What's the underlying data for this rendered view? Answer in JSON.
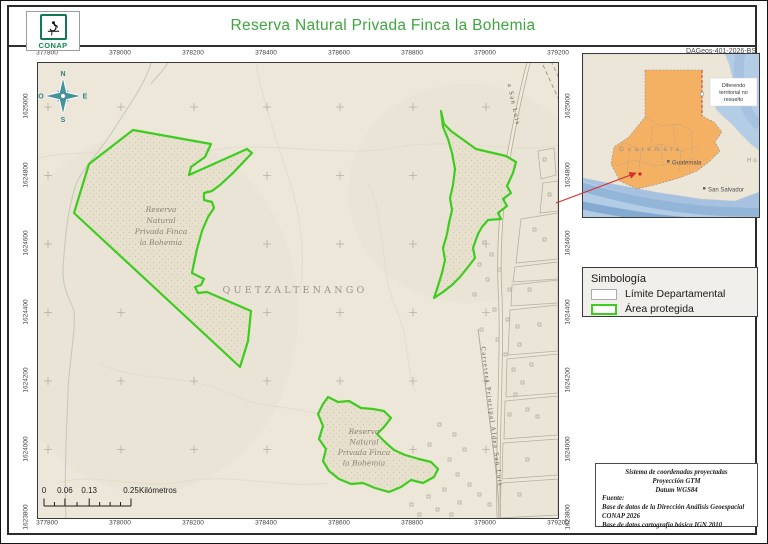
{
  "header": {
    "title": "Reserva Natural Privada Finca la Bohemia",
    "logo_text": "CONAP",
    "doc_code": "DAGeos-401-2026-BS"
  },
  "map": {
    "x_labels": [
      "377800",
      "378000",
      "378200",
      "378400",
      "378600",
      "378800",
      "379000",
      "379200"
    ],
    "y_labels": [
      "1625000",
      "1624800",
      "1624600",
      "1624400",
      "1624200",
      "1624000",
      "1623800"
    ],
    "reserve_label_lines": [
      "Reserva",
      "Natural",
      "Privada Finca",
      "la Bohemia"
    ],
    "department_label": "QUETZALTENANGO",
    "road_label_top": "a San Luis",
    "road_label_main": "Carretera Principal Aldea San Luis",
    "compass": {
      "north": "N",
      "east": "E",
      "south": "S",
      "west": "O"
    },
    "scalebar": {
      "tick_labels": [
        "0",
        "0.06",
        "0.13",
        "0.25"
      ],
      "unit": "Kilómetros"
    }
  },
  "inset": {
    "country_label": "G u a t e m a l a",
    "capital_label": "Guatemala",
    "city_label": "San Salvador",
    "edge_label": "H o",
    "note_lines": [
      "Diferendo",
      "territorial no",
      "resuelto"
    ]
  },
  "legend": {
    "title": "Simbología",
    "items": [
      {
        "label": "Límite Departamental",
        "swatch": "department"
      },
      {
        "label": "Área protegida",
        "swatch": "protected"
      }
    ]
  },
  "credits": {
    "line1": "Sistema de coordenadas proyectadas",
    "line2": "Proyección GTM",
    "line3": "Datum WGS84",
    "source_heading": "Fuente:",
    "source1": "Base de datos de la Dirección Análisis Geoespacial",
    "source1b": "CONAP 2026",
    "source2": "Base de datos cartografía básica IGN 2010"
  },
  "colors": {
    "title_green": "#3fa53f",
    "protected_green": "#3ecc1f",
    "guatemala_orange": "#f4b164",
    "sea_blue": "#b4cde7",
    "map_bg": "#ece7d9",
    "leader_red": "#d62f2f"
  }
}
